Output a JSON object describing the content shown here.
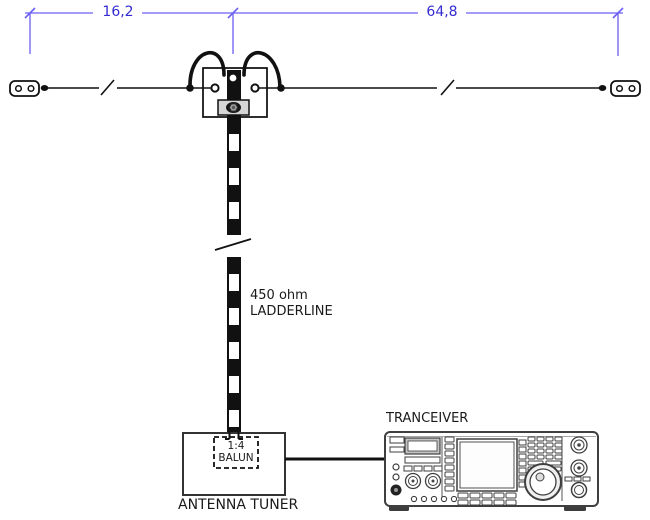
{
  "dimensions": {
    "left": "16,2",
    "right": "64,8"
  },
  "ladderline": {
    "line1": "450 ohm",
    "line2": "LADDERLINE"
  },
  "balun": {
    "ratio": "1:4",
    "label": "BALUN"
  },
  "tuner_label": "ANTENNA TUNER",
  "transceiver_label": "TRANCEIVER",
  "colors": {
    "dimension_line": "#6b5ff2",
    "dimension_text": "#342bd2",
    "line_art": "#111111"
  }
}
